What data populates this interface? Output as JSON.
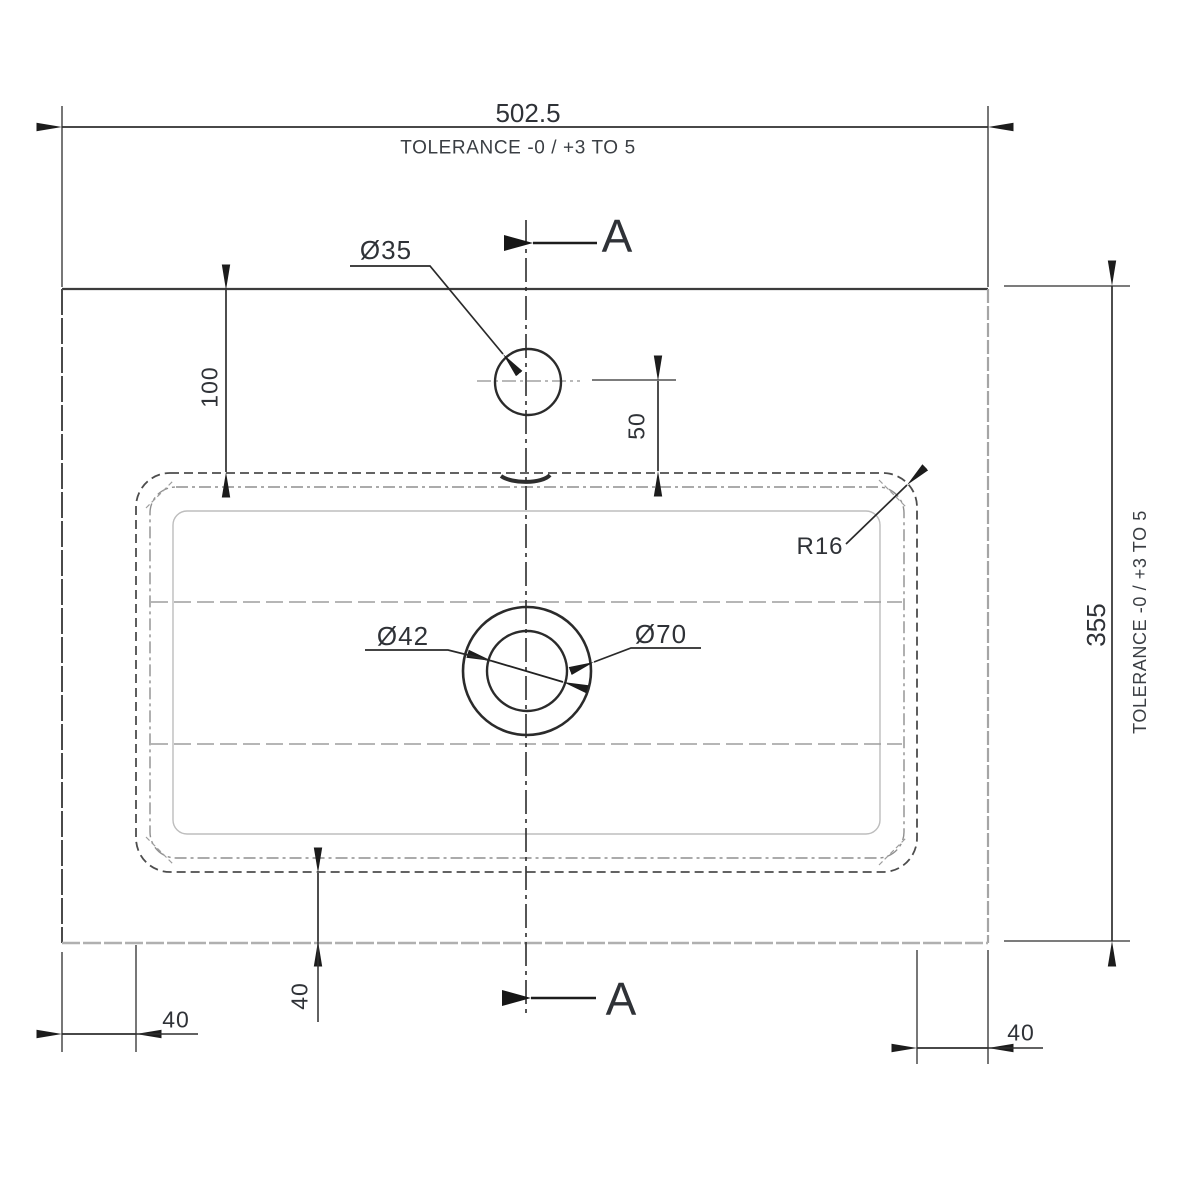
{
  "drawing": {
    "section": {
      "label": "A"
    },
    "dimensions": {
      "overall_width": "502.5",
      "overall_width_tolerance": "TOLERANCE -0 / +3 TO 5",
      "overall_depth": "355",
      "overall_depth_tolerance": "TOLERANCE -0 / +3 TO 5",
      "tap_hole_offset_from_back": "100",
      "tap_hole_to_bowl": "50",
      "bowl_to_front_edge": "40",
      "bowl_left_margin": "40",
      "bowl_right_margin": "40"
    },
    "callouts": {
      "tap_hole_diameter": "Ø35",
      "waste_inner_diameter": "Ø42",
      "waste_outer_diameter": "Ø70",
      "bowl_corner_radius": "R16"
    },
    "colors": {
      "line_primary": "#2c2c2c",
      "line_secondary": "#9d9d9d",
      "background": "#ffffff"
    }
  }
}
